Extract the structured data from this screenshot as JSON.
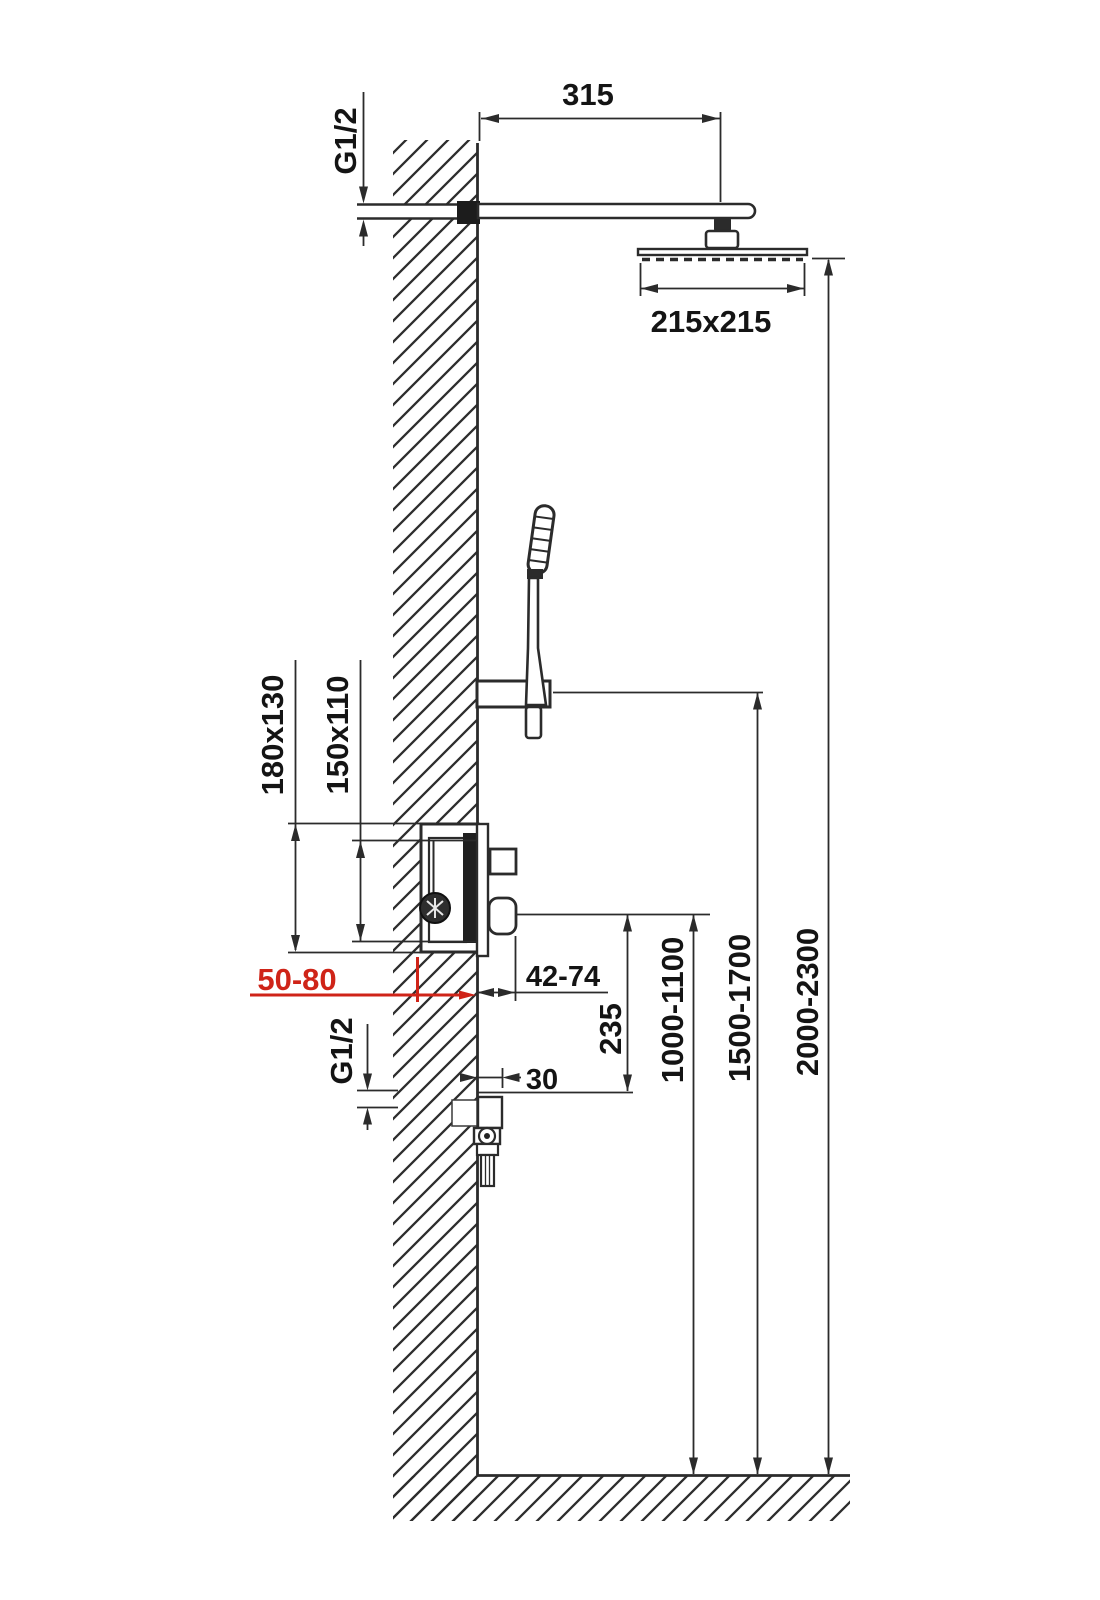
{
  "page": {
    "background": "#ffffff"
  },
  "diagram": {
    "title": "Shower column installation dimension drawing",
    "type": "technical-dimension-diagram",
    "units": "mm",
    "colors": {
      "line": "#2b2b2b",
      "text": "#141414",
      "accent_red": "#cf2418",
      "background": "#ffffff"
    },
    "labels": {
      "arm_length": "315",
      "connection_top": "G1/2",
      "head_size": "215x215",
      "rough_in_box_outer": "180x130",
      "rough_in_box_inner": "150x110",
      "embed_depth_range": "50-80",
      "trim_projection_range": "42-74",
      "spout_drop": "235",
      "outlet_projection": "30",
      "connection_bottom": "G1/2",
      "mixer_height_range": "1000-1100",
      "hand_shower_height_range": "1500-1700",
      "head_height_range": "2000-2300"
    }
  }
}
